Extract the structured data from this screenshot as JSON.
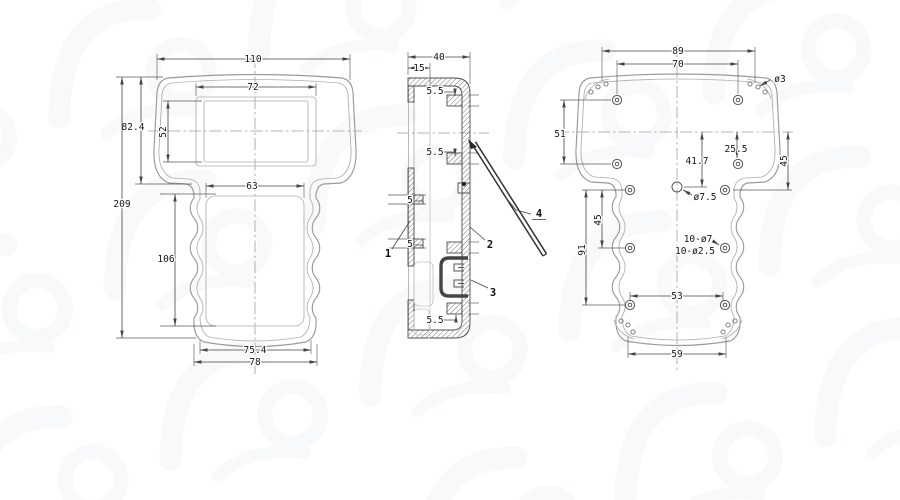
{
  "drawing": {
    "front": {
      "dim_overall_width": "110",
      "dim_head_height": "82.4",
      "dim_overall_height": "209",
      "dim_screen_width": "72",
      "dim_screen_height": "52",
      "dim_body_top_width": "63",
      "dim_body_height": "106",
      "dim_bottom_inner_width": "75.4",
      "dim_bottom_outer_width": "78"
    },
    "side": {
      "dim_depth": "40",
      "dim_front_depth": "15",
      "dim_boss_top": "5.5",
      "dim_boss_mid": "5.5",
      "dim_boss_bottom": "5.5",
      "dim_rib_upper": "5",
      "dim_rib_lower": "5",
      "callout_front_shell": "1",
      "callout_rear_shell": "2",
      "callout_battery_compartment": "3",
      "callout_tilt_stand": "4"
    },
    "back": {
      "dim_corner_hole_span": "89",
      "dim_top_boss_span": "70",
      "note_corner_hole_dia": "ø3",
      "dim_upper_boss_pitch": "51",
      "dim_center_offset": "25.5",
      "dim_hole_drop": "41.7",
      "dim_right_span": "45",
      "note_center_hole_dia": "ø7.5",
      "dim_left_span_small": "45",
      "dim_left_span_large": "91",
      "note_boss_outer": "10-ø7",
      "note_boss_inner": "10-ø2.5",
      "dim_lower_boss_span": "53",
      "dim_bottom_span": "59"
    }
  }
}
